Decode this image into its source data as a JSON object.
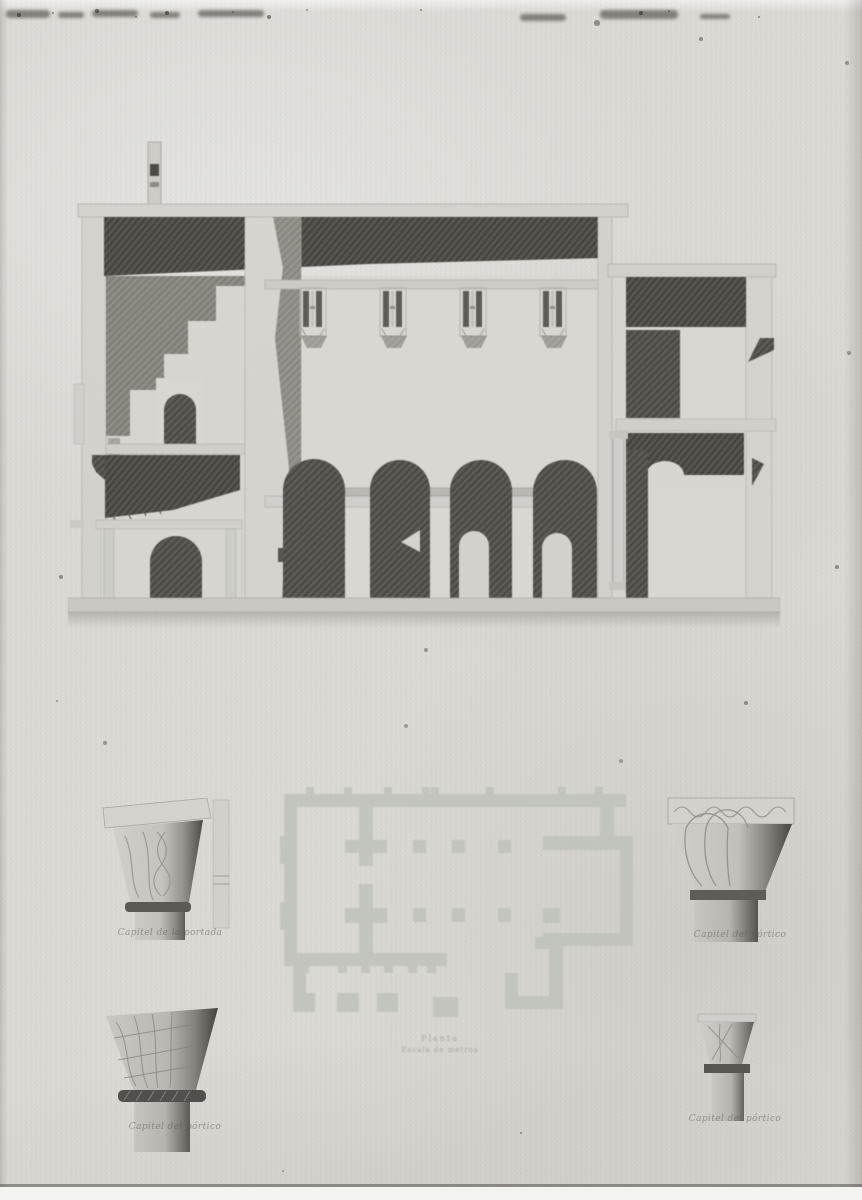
{
  "captions": {
    "capital_top_left": "Capitel de la portada",
    "capital_top_right": "Capitel del pórtico",
    "capital_bottom_left": "Capitel del pórtico",
    "capital_bottom_right": "Capitel del pórtico",
    "plan_title": "Planta",
    "plan_scale": "Escala de metros"
  },
  "colors": {
    "paper": "#dbdad5",
    "ink_dark": "#47453f",
    "ink_mid": "#8b8984",
    "wall_light": "#d2d1cc",
    "plan_wall": "#bfc1bb",
    "bottom_margin": "#f3f3f1"
  }
}
